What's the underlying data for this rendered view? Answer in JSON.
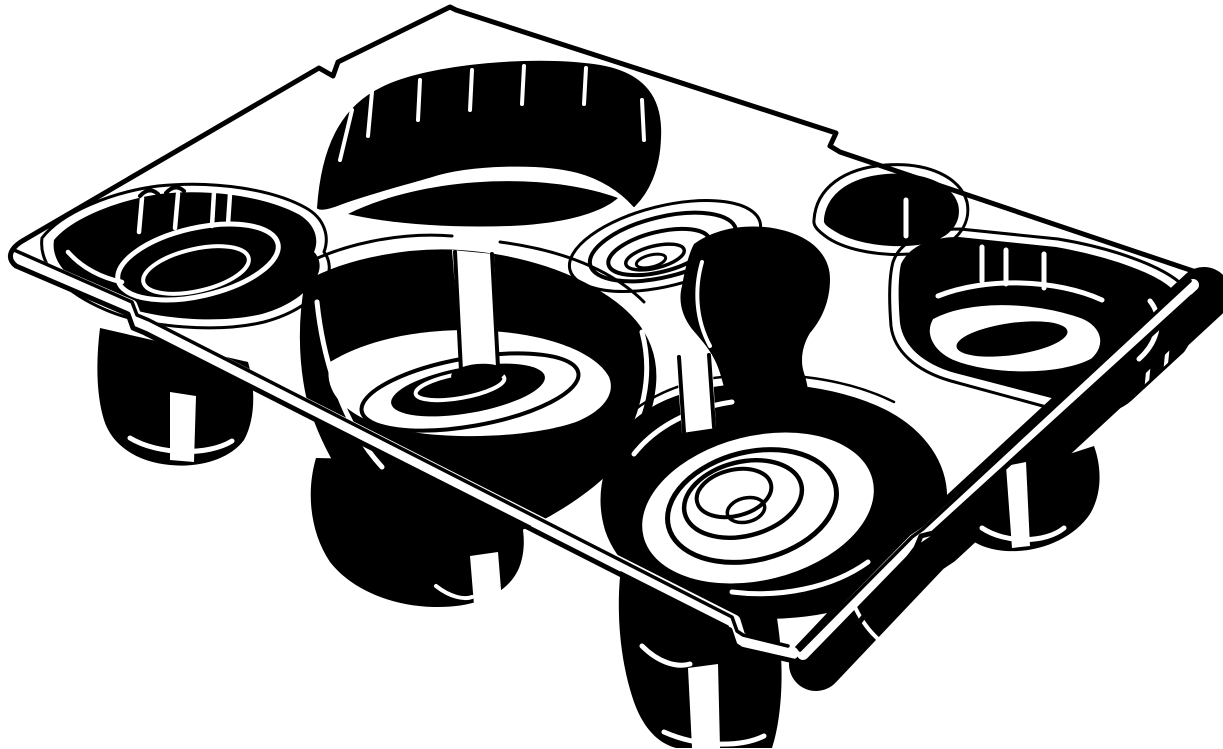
{
  "figure": {
    "alt": "Black-and-white line-art illustration of a thermoformed tray insert with multiple molded pockets and cylindrical feet, drawn in isometric perspective",
    "width": 1223,
    "height": 749
  },
  "palette": {
    "ink": "#000000",
    "paper": "#ffffff"
  },
  "shapes": [
    {
      "name": "background",
      "type": "path",
      "d": "M0,0H1223V749H0Z",
      "fill": "paper"
    },
    {
      "name": "skirt-bottom-right",
      "type": "path",
      "d": "M816,664 L926,548 L938,540 L1204,294",
      "stroke": "ink",
      "sw": 54
    },
    {
      "name": "foot-left-body",
      "type": "path",
      "d": "M100,328 L248,362 C256,390 255,420 244,440 C230,459 200,468 170,465 C138,462 112,446 104,420 C96,394 96,360 100,328 Z",
      "fill": "ink"
    },
    {
      "name": "foot-left-stripe",
      "type": "path",
      "d": "M170,392 L196,396 L194,462 L170,460 Z",
      "fill": "paper"
    },
    {
      "name": "foot-left-arc",
      "type": "path",
      "d": "M130,438 C158,455 208,456 232,441",
      "stroke": "paper",
      "sw": 5
    },
    {
      "name": "foot-midleft-body",
      "type": "path",
      "d": "M316,458 C306,492 310,532 330,562 C352,590 392,606 434,607 C476,608 508,594 519,568 C528,546 524,516 510,494 L506,462 Z",
      "fill": "ink"
    },
    {
      "name": "foot-midleft-stripe",
      "type": "path",
      "d": "M470,556 L498,552 L502,602 L474,605 Z",
      "fill": "paper"
    },
    {
      "name": "foot-midleft-arc",
      "type": "path",
      "d": "M436,586 C450,597 464,600 472,597",
      "stroke": "paper",
      "sw": 4
    },
    {
      "name": "foot-bottom-body",
      "type": "path",
      "d": "M622,560 C616,600 618,652 632,696 C640,722 654,742 676,748 L772,748 C780,724 784,684 780,642 C776,600 768,574 758,556 Z",
      "fill": "ink"
    },
    {
      "name": "foot-bottom-stripe",
      "type": "path",
      "d": "M688,668 L718,664 L720,748 L692,748 Z",
      "fill": "paper"
    },
    {
      "name": "foot-bottom-curves",
      "type": "path",
      "d": "M642,646 C658,662 676,668 690,664 M664,732 C700,748 742,747 764,736",
      "stroke": "paper",
      "sw": 5
    },
    {
      "name": "foot-right-body",
      "type": "path",
      "d": "M958,490 L1094,446 C1102,468 1102,494 1090,514 C1074,538 1040,553 1006,551 C978,549 960,536 955,518 C951,505 953,497 958,490 Z",
      "fill": "ink"
    },
    {
      "name": "foot-right-stripe",
      "type": "path",
      "d": "M1006,466 L1026,462 L1030,546 L1012,548 Z",
      "fill": "paper"
    },
    {
      "name": "foot-right-arc",
      "type": "path",
      "d": "M982,528 C1006,544 1046,543 1064,528",
      "stroke": "paper",
      "sw": 5
    },
    {
      "name": "skirt-highlights",
      "type": "path",
      "d": "M1150,352 L1146,392 M1168,344 L1164,384 M836,540 L832,576 M852,600 C862,626 880,645 900,653",
      "stroke": "paper",
      "sw": 4
    },
    {
      "name": "pocket1-rim",
      "type": "path",
      "d": "M42,238 C62,212 112,192 158,186 C216,180 274,190 306,208 C324,218 330,236 324,252 C330,260 332,272 324,284 C314,300 294,314 264,322 C218,333 148,328 106,310 C68,294 38,268 42,238 Z",
      "stroke": "ink",
      "sw": 3
    },
    {
      "name": "pocket1-body",
      "type": "path",
      "d": "M54,240 C72,218 118,200 160,194 C214,188 268,198 298,214 C314,223 320,238 314,252 C320,258 322,268 316,278 C308,292 290,306 262,314 C220,324 152,320 112,302 C77,287 50,266 54,240 Z",
      "fill": "ink"
    },
    {
      "name": "pocket1-cup-outer",
      "type": "ellipse",
      "cx": 198,
      "cy": 262,
      "rx": 82,
      "ry": 34,
      "rot": -13,
      "stroke": "paper",
      "sw": 5
    },
    {
      "name": "pocket1-cup-inner",
      "type": "ellipse",
      "cx": 196,
      "cy": 270,
      "rx": 54,
      "ry": 21,
      "rot": -13,
      "stroke": "paper",
      "sw": 4
    },
    {
      "name": "pocket1-highlights",
      "type": "path",
      "d": "M68,252 C82,268 102,278 122,282 M142,198 L139,232 M178,194 L175,228 M214,192 L212,226 M230,194 L228,224",
      "stroke": "paper",
      "sw": 4.5
    },
    {
      "name": "pocket1-tabs",
      "type": "path",
      "d": "M140,196 Q149,186 158,194 M166,193 Q175,183 184,191",
      "stroke": "ink",
      "sw": 4
    },
    {
      "name": "divider-wall-body",
      "type": "path",
      "d": "M318,208 C322,150 340,108 382,88 C430,64 540,56 600,66 C646,74 662,100 660,138 C659,170 648,192 634,206 C620,190 600,178 578,172 C540,162 470,164 432,176 C398,186 360,196 340,204 C330,208 322,210 318,208 Z",
      "fill": "ink",
      "stroke": "ink",
      "sw": 2
    },
    {
      "name": "divider-wall-slits",
      "type": "path",
      "d": "M372,92 L368,136 M420,80 L418,120 M472,70 L470,110 M524,66 L522,104 M586,68 L584,104 M642,100 L644,140 M352,110 L340,160",
      "stroke": "paper",
      "sw": 4
    },
    {
      "name": "divider-wall-ridge",
      "type": "path",
      "d": "M348,214 C420,178 540,170 618,198 C600,214 560,224 510,226 C450,228 390,224 348,214 Z",
      "fill": "ink"
    },
    {
      "name": "well-ring-outer",
      "type": "ellipse",
      "cx": 665,
      "cy": 246,
      "rx": 98,
      "ry": 40,
      "rot": -14,
      "stroke": "ink",
      "sw": 3
    },
    {
      "name": "well-ring-1",
      "type": "ellipse",
      "cx": 663,
      "cy": 247,
      "rx": 75,
      "ry": 30,
      "rot": -14,
      "stroke": "ink",
      "sw": 4
    },
    {
      "name": "well-ring-2",
      "type": "ellipse",
      "cx": 659,
      "cy": 252,
      "rx": 52,
      "ry": 20,
      "rot": -14,
      "stroke": "ink",
      "sw": 4
    },
    {
      "name": "well-ring-3",
      "type": "ellipse",
      "cx": 655,
      "cy": 257,
      "rx": 30,
      "ry": 11,
      "rot": -14,
      "stroke": "ink",
      "sw": 3.5
    },
    {
      "name": "well-ring-4",
      "type": "ellipse",
      "cx": 651,
      "cy": 261,
      "rx": 15,
      "ry": 6,
      "rot": -14,
      "stroke": "ink",
      "sw": 3
    },
    {
      "name": "pocket5-rim",
      "type": "path",
      "d": "M814,220 C816,188 844,168 886,165 C928,162 960,177 967,202 C972,226 954,248 920,253 C884,258 846,250 828,238 C818,231 813,226 814,220 Z",
      "stroke": "ink",
      "sw": 3
    },
    {
      "name": "pocket5-body",
      "type": "path",
      "d": "M824,220 C826,194 850,177 886,174 C924,171 952,184 958,204 C963,224 948,241 918,245 C886,249 852,242 836,232 C828,227 823,224 824,220 Z",
      "fill": "ink"
    },
    {
      "name": "pocket5-tick",
      "type": "path",
      "d": "M906,200 L906,236",
      "stroke": "paper",
      "sw": 5
    },
    {
      "name": "pocket6-rim",
      "type": "path",
      "d": "M893,262 C900,241 926,229 960,229 L1058,239 C1118,249 1170,269 1186,289 C1199,306 1197,331 1183,351 L1131,399 C1116,413 1091,416 1061,411 L951,381 C916,371 894,351 891,326 C889,301 889,277 893,262 Z",
      "stroke": "ink",
      "sw": 3
    },
    {
      "name": "pocket6-body",
      "type": "path",
      "d": "M901,264 C909,247 929,237 959,237 L1056,247 C1112,257 1162,275 1176,293 C1188,308 1186,329 1173,347 L1127,391 C1113,403 1091,407 1063,401 L955,373 C923,364 903,346 900,323 C898,301 898,277 901,264 Z",
      "fill": "ink"
    },
    {
      "name": "pocket6-floor",
      "type": "path",
      "d": "M932,318 C966,299 1032,299 1082,317 C1104,326 1108,346 1092,360 C1061,377 990,377 952,361 C931,351 923,333 932,318 Z",
      "fill": "paper",
      "stroke": "ink",
      "sw": 3
    },
    {
      "name": "pocket6-floor-oval",
      "type": "ellipse",
      "cx": 1012,
      "cy": 339,
      "rx": 56,
      "ry": 16,
      "rot": -8,
      "fill": "ink"
    },
    {
      "name": "pocket6-highlights",
      "type": "path",
      "d": "M938,296 C986,277 1056,279 1102,300 M1150,301 C1163,317 1159,341 1139,359 M982,247 L982,281 M1006,250 L1006,284 M1044,254 L1044,288",
      "stroke": "paper",
      "sw": 5
    },
    {
      "name": "pocket7-rim",
      "type": "path",
      "d": "M294,270 C340,243 402,232 452,236 M500,242 C562,250 612,270 644,302",
      "stroke": "ink",
      "sw": 3
    },
    {
      "name": "pocket7-body",
      "type": "path",
      "d": "M306,282 C350,257 415,248 460,251 C520,255 576,273 616,303 C646,326 660,356 654,393 C650,426 626,459 593,486 C559,513 516,536 473,545 C436,551 403,541 376,516 C346,489 319,441 307,396 C299,359 299,317 306,282 Z",
      "fill": "ink",
      "stroke": "ink",
      "sw": 2
    },
    {
      "name": "pocket7-floor",
      "type": "path",
      "d": "M330,362 C371,337 431,327 491,331 C551,335 596,353 609,377 C616,394 603,411 576,422 C526,439 436,441 383,426 C346,415 322,392 330,362 Z",
      "fill": "paper"
    },
    {
      "name": "pocket7-floor-ring",
      "type": "ellipse",
      "cx": 470,
      "cy": 392,
      "rx": 110,
      "ry": 34,
      "rot": -10,
      "stroke": "ink",
      "sw": 4
    },
    {
      "name": "pocket7-floor-oval",
      "type": "ellipse",
      "cx": 468,
      "cy": 390,
      "rx": 78,
      "ry": 23,
      "rot": -10,
      "fill": "ink"
    },
    {
      "name": "pocket7-floor-arc",
      "type": "ellipse",
      "cx": 460,
      "cy": 386,
      "rx": 45,
      "ry": 12,
      "rot": -10,
      "stroke": "paper",
      "sw": 4
    },
    {
      "name": "pocket7-wall-highlights",
      "type": "path",
      "d": "M317,302 C323,360 343,425 382,467 M642,332 C653,373 645,424 612,461",
      "stroke": "paper",
      "sw": 5
    },
    {
      "name": "pocket7-post",
      "type": "path",
      "d": "M452,250 L494,254 L499,368 L462,373 Z",
      "fill": "paper"
    },
    {
      "name": "pocket7-post-edges",
      "type": "path",
      "d": "M455,252 L461,371 M492,254 L498,367",
      "stroke": "ink",
      "sw": 4
    },
    {
      "name": "pocket7-post-base",
      "type": "ellipse",
      "cx": 478,
      "cy": 374,
      "rx": 27,
      "ry": 10,
      "rot": -5,
      "fill": "ink"
    },
    {
      "name": "channel-body",
      "type": "path",
      "d": "M694,244 C718,226 758,221 792,233 C817,242 830,259 830,279 C830,301 822,319 810,333 C802,346 800,361 804,373 C810,391 810,406 802,419 C792,433 774,439 757,433 C742,428 732,416 728,401 L720,373 C714,353 702,341 692,329 C682,316 678,301 682,286 C685,269 689,253 694,244 Z",
      "fill": "ink"
    },
    {
      "name": "channel-highlight",
      "type": "path",
      "d": "M702,262 C694,290 696,320 710,346",
      "stroke": "paper",
      "sw": 4
    },
    {
      "name": "pocket8-rim",
      "type": "path",
      "d": "M598,472 C602,426 646,392 702,380 C766,368 842,376 894,402",
      "stroke": "ink",
      "sw": 2.5
    },
    {
      "name": "pocket8-body",
      "type": "path",
      "d": "M606,470 C612,430 650,400 702,390 C762,378 834,386 884,410 C924,430 948,464 946,502 C944,544 914,580 868,600 C820,620 746,624 698,608 C654,594 618,566 606,530 C600,510 600,490 606,470 Z",
      "fill": "ink",
      "stroke": "ink",
      "sw": 2
    },
    {
      "name": "pocket8-floor",
      "type": "ellipse",
      "cx": 758,
      "cy": 508,
      "rx": 118,
      "ry": 72,
      "rot": -14,
      "fill": "paper"
    },
    {
      "name": "pocket8-spiral-1",
      "type": "ellipse",
      "cx": 752,
      "cy": 506,
      "rx": 86,
      "ry": 54,
      "rot": -14,
      "stroke": "ink",
      "sw": 5
    },
    {
      "name": "pocket8-spiral-2",
      "type": "ellipse",
      "cx": 743,
      "cy": 499,
      "rx": 60,
      "ry": 37,
      "rot": -14,
      "stroke": "ink",
      "sw": 4.5
    },
    {
      "name": "pocket8-spiral-3",
      "type": "ellipse",
      "cx": 734,
      "cy": 493,
      "rx": 38,
      "ry": 23,
      "rot": -14,
      "stroke": "ink",
      "sw": 4
    },
    {
      "name": "pocket8-spiral-4",
      "type": "ellipse",
      "cx": 746,
      "cy": 510,
      "rx": 19,
      "ry": 12,
      "rot": -14,
      "stroke": "ink",
      "sw": 3.5
    },
    {
      "name": "pocket8-highlights",
      "type": "path",
      "d": "M634,454 C656,426 692,408 732,402 M868,562 C832,588 780,598 732,592",
      "stroke": "paper",
      "sw": 5
    },
    {
      "name": "channel-post",
      "type": "path",
      "d": "M676,358 L712,354 L716,428 L682,433 Z",
      "fill": "paper"
    },
    {
      "name": "channel-post-edges",
      "type": "path",
      "d": "M679,357 L684,432 M709,355 L714,427",
      "stroke": "ink",
      "sw": 4
    },
    {
      "name": "flange-band-bottom-left",
      "type": "path",
      "d": "M11,254 L131,306 L136,319 L148,325 L734,621 L739,637 L745,641 L792,653",
      "stroke": "paper",
      "sw": 13
    },
    {
      "name": "flange-band-bottom-right",
      "type": "path",
      "d": "M803,654 L914,540 L926,532 L1193,285",
      "stroke": "paper",
      "sw": 12
    },
    {
      "name": "flange-outline",
      "type": "path",
      "d": "M450,7 L338,62 L333,76 L319,68 L24,240 C10,248 6,258 16,266 L128,314 L133,328 L145,333 L730,630 L735,645 L741,649 L798,662 C810,672 826,670 832,658 L916,548 L921,536 L933,533 L1192,297 C1204,291 1206,279 1196,272 L840,152 L830,146 L836,133 L456,10 Z",
      "stroke": "ink",
      "sw": 5
    },
    {
      "name": "flange-inner-line-bottom-left",
      "type": "path",
      "d": "M14,250 L132,302 L137,315 L149,320 L732,617 L737,631 L743,635 L788,646",
      "stroke": "ink",
      "sw": 3.5
    },
    {
      "name": "flange-inner-line-bottom-right",
      "type": "path",
      "d": "M800,650 L912,537 L923,529 L1190,281",
      "stroke": "ink",
      "sw": 3.5
    }
  ]
}
